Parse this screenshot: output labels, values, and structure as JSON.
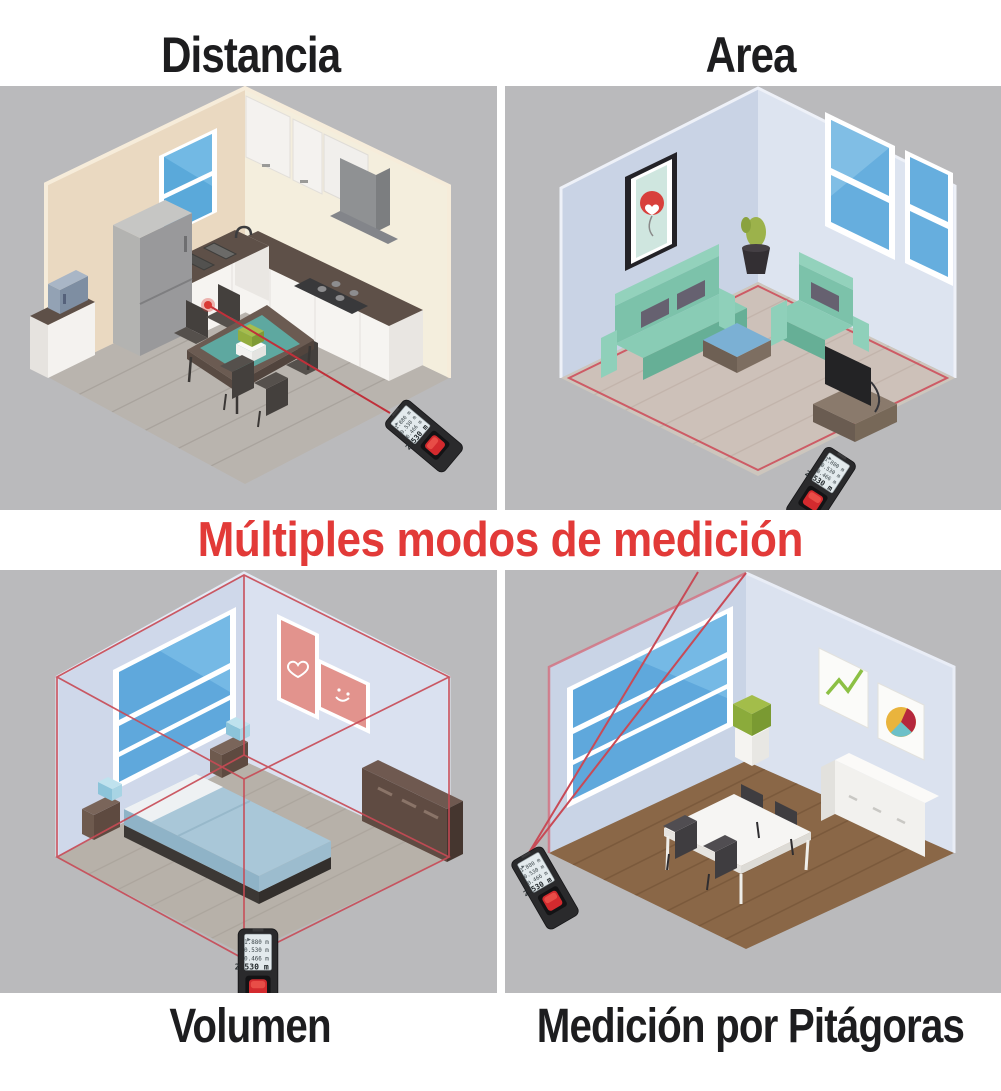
{
  "titles": {
    "top_left": "Distancia",
    "top_right": "Area",
    "bottom_left": "Volumen",
    "bottom_right": "Medición por Pitágoras"
  },
  "heading": {
    "text": "Múltiples modos de medición",
    "color": "#e23a38"
  },
  "device_display": {
    "line1": "1.880 m",
    "line2": "0.530 m",
    "line3": "0.466 m",
    "result": "2.530 m"
  },
  "panels": [
    {
      "scene": "kitchen-isometric",
      "laser_overlay": "single-distance-line-with-dot"
    },
    {
      "scene": "living-room-isometric",
      "laser_overlay": "floor-perimeter-outline"
    },
    {
      "scene": "bedroom-isometric",
      "laser_overlay": "room-volume-wireframe-box"
    },
    {
      "scene": "dining-room-isometric",
      "laser_overlay": "pythagoras-triangle-lines"
    }
  ],
  "colors": {
    "panel_background": "#bababc",
    "laser_red": "#cf4a50",
    "heading_red": "#e23a38",
    "title_text": "#1d1d1f",
    "device_body": "#2a2a2c",
    "device_button": "#d32a2e",
    "device_screen": "#e3eaed"
  }
}
